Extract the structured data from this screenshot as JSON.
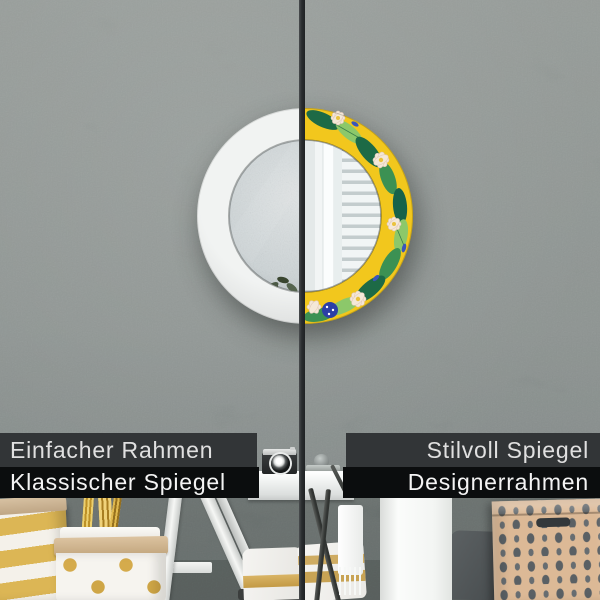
{
  "product_labels": {
    "left": {
      "line1": "Einfacher Rahmen",
      "line2": "Klassischer Spiegel"
    },
    "right": {
      "line1": "Stilvoll Spiegel",
      "line2": "Designerrahmen"
    }
  },
  "colors": {
    "wall": "#838a87",
    "wall_dark": "#6b7270",
    "divider": "#2b2e30",
    "bar_top": "#323537",
    "bar_bottom": "#0b0d0e",
    "label_text": "#f0f0f0",
    "frame_white": "#e5e7e6",
    "pattern_yellow": "#f2c71d",
    "pattern_green_dark": "#1d6a46",
    "pattern_green_mid": "#3c9153",
    "pattern_green_light": "#8cc86a",
    "pattern_blue": "#3a55bb",
    "pattern_cream": "#f4e8d8",
    "gold_accent": "#d2a94f",
    "kraft_paper": "#c9ae8c",
    "box_tan": "#dcb996",
    "box_motif": "#5a6064"
  }
}
